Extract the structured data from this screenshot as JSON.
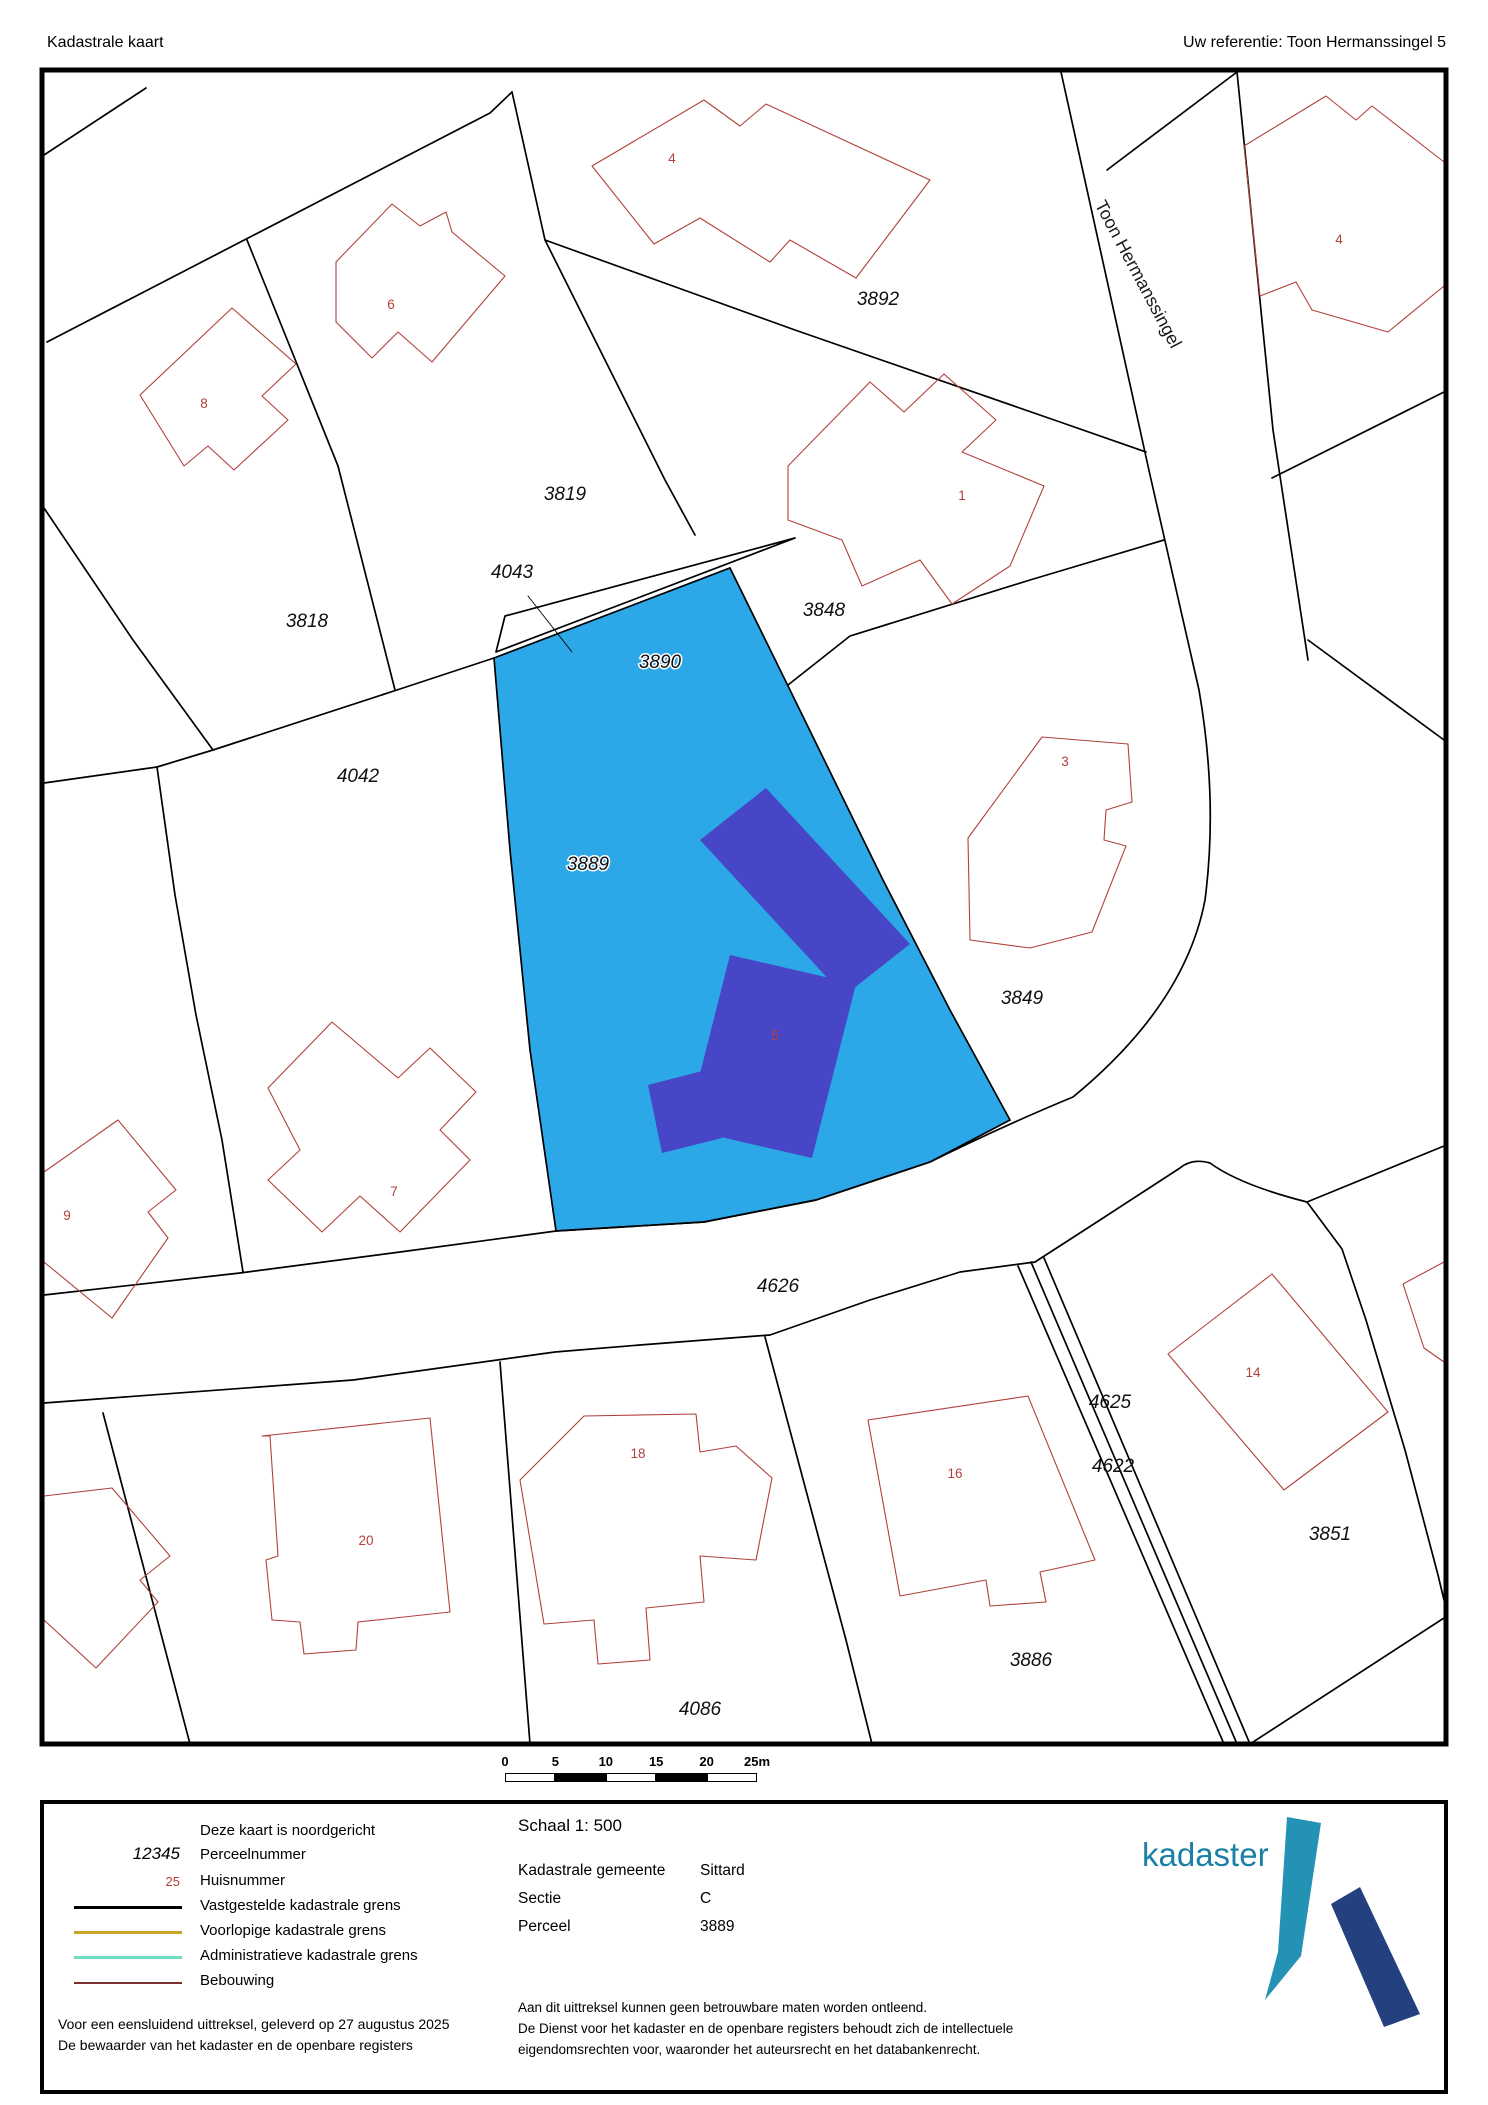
{
  "header": {
    "title": "Kadastrale kaart",
    "reference": "Uw referentie: Toon Hermanssingel 5"
  },
  "map": {
    "street_label": {
      "text": "Toon Hermanssingel",
      "x": 1133,
      "y": 277,
      "angle": 62
    },
    "parcel_labels": [
      {
        "text": "3892",
        "x": 878,
        "y": 305
      },
      {
        "text": "3819",
        "x": 565,
        "y": 500
      },
      {
        "text": "4043",
        "x": 512,
        "y": 578
      },
      {
        "text": "3818",
        "x": 307,
        "y": 627
      },
      {
        "text": "3848",
        "x": 824,
        "y": 616
      },
      {
        "text": "4042",
        "x": 358,
        "y": 782
      },
      {
        "text": "3849",
        "x": 1022,
        "y": 1004
      },
      {
        "text": "4626",
        "x": 778,
        "y": 1292
      },
      {
        "text": "4625",
        "x": 1110,
        "y": 1408
      },
      {
        "text": "4622",
        "x": 1113,
        "y": 1472
      },
      {
        "text": "3851",
        "x": 1330,
        "y": 1540
      },
      {
        "text": "3886",
        "x": 1031,
        "y": 1666
      },
      {
        "text": "4086",
        "x": 700,
        "y": 1715
      }
    ],
    "highlighted_parcel_labels": [
      {
        "text": "3890",
        "x": 660,
        "y": 668
      },
      {
        "text": "3889",
        "x": 588,
        "y": 870
      }
    ],
    "house_numbers": [
      {
        "text": "4",
        "x": 672,
        "y": 163
      },
      {
        "text": "6",
        "x": 391,
        "y": 309
      },
      {
        "text": "8",
        "x": 204,
        "y": 408
      },
      {
        "text": "1",
        "x": 962,
        "y": 500
      },
      {
        "text": "4",
        "x": 1339,
        "y": 244
      },
      {
        "text": "3",
        "x": 1065,
        "y": 766
      },
      {
        "text": "5",
        "x": 775,
        "y": 1040
      },
      {
        "text": "7",
        "x": 394,
        "y": 1196
      },
      {
        "text": "9",
        "x": 67,
        "y": 1220
      },
      {
        "text": "20",
        "x": 366,
        "y": 1545
      },
      {
        "text": "18",
        "x": 638,
        "y": 1458
      },
      {
        "text": "16",
        "x": 955,
        "y": 1478
      },
      {
        "text": "14",
        "x": 1253,
        "y": 1377
      }
    ],
    "colors": {
      "highlight_parcel": "#2CA8E8",
      "building": "#4646C6",
      "house_outline": "#B0413B",
      "boundary": "#000000"
    }
  },
  "scale_bar": {
    "ticks": [
      "0",
      "5",
      "10",
      "15",
      "20",
      "25m"
    ],
    "segments": 5
  },
  "legend": {
    "north_note": "Deze kaart is noordgericht",
    "items": [
      {
        "sample": "12345",
        "label": "Perceelnummer"
      },
      {
        "sample": "25",
        "label": "Huisnummer"
      },
      {
        "label": "Vastgestelde kadastrale grens"
      },
      {
        "label": "Voorlopige kadastrale grens"
      },
      {
        "label": "Administratieve kadastrale grens"
      },
      {
        "label": "Bebouwing"
      }
    ],
    "legend_colors": {
      "vastgesteld": "#000000",
      "voorlopig": "#C9A227",
      "administratief": "#70DBC5",
      "bebouwing": "#7A3030"
    },
    "footer_line1": "Voor een eensluidend uittreksel, geleverd op 27 augustus 2025",
    "footer_line2": "De bewaarder van het kadaster en de openbare registers"
  },
  "info": {
    "scale_label": "Schaal 1: 500",
    "rows": [
      {
        "label": "Kadastrale gemeente",
        "value": "Sittard"
      },
      {
        "label": "Sectie",
        "value": "C"
      },
      {
        "label": "Perceel",
        "value": "3889"
      }
    ],
    "disclaimer": [
      "Aan dit uittreksel kunnen geen betrouwbare maten worden ontleend.",
      "De Dienst voor het kadaster en de openbare registers behoudt zich de intellectuele",
      "eigendomsrechten voor, waaronder het auteursrecht en het databankenrecht."
    ]
  },
  "logo": {
    "wordmark": "kadaster",
    "colors": {
      "text": "#1B80A6",
      "blade": "#2492B4",
      "stroke_mark": "#24407E"
    }
  }
}
